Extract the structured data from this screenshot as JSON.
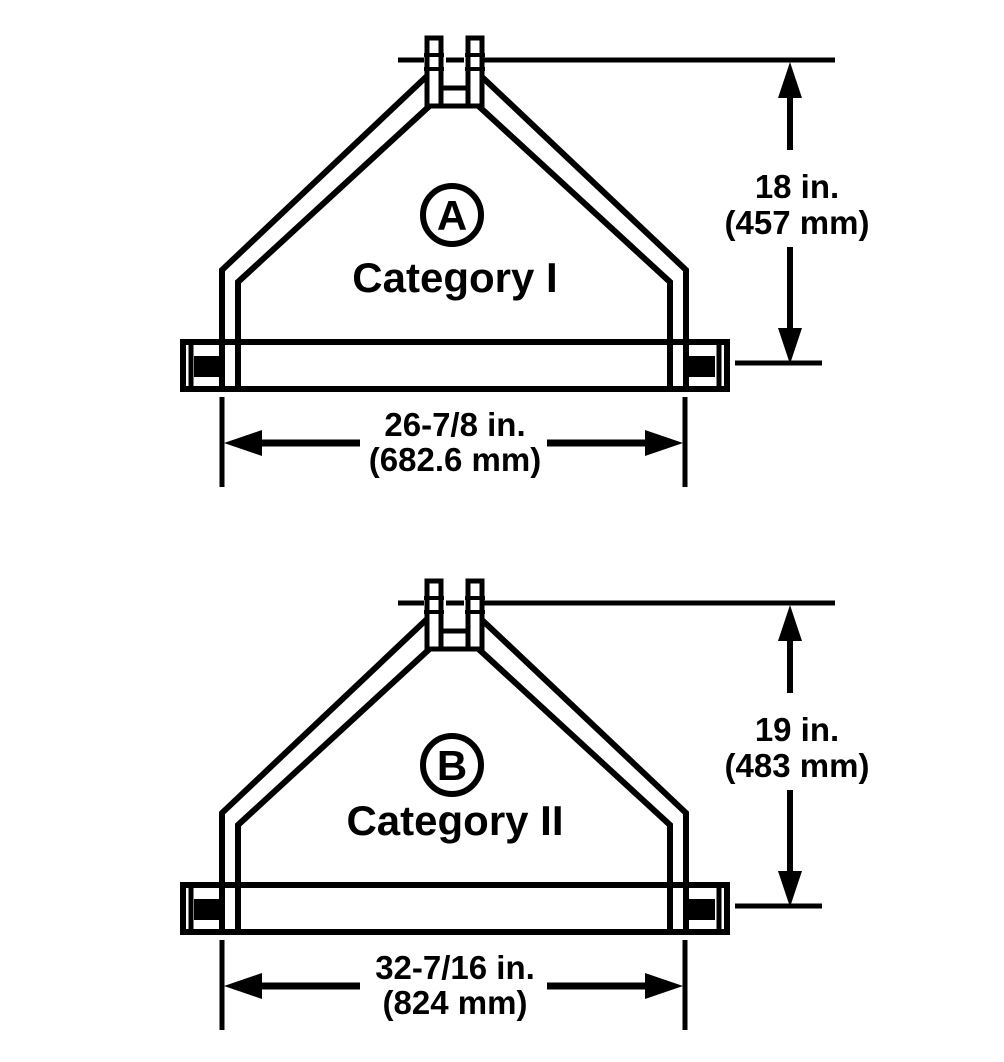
{
  "figure": {
    "kind": "three-point-hitch-frame-dimension-diagram",
    "colors": {
      "ink": "#000000",
      "paper": "#ffffff"
    }
  },
  "diagrams": [
    {
      "badge_letter": "A",
      "category_label": "Category I",
      "mast_height_dimension": {
        "imperial": "18 in.",
        "metric": "(457 mm)"
      },
      "link_spread_dimension": {
        "imperial": "26-7/8 in.",
        "metric": "(682.6 mm)"
      }
    },
    {
      "badge_letter": "B",
      "category_label": "Category II",
      "mast_height_dimension": {
        "imperial": "19 in.",
        "metric": "(483 mm)"
      },
      "link_spread_dimension": {
        "imperial": "32-7/16 in.",
        "metric": "(824 mm)"
      }
    }
  ]
}
